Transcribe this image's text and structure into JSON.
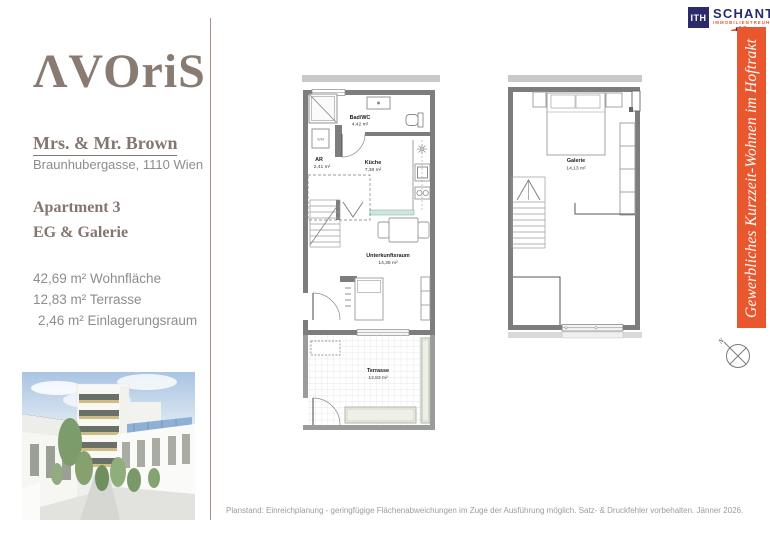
{
  "brand": {
    "logo_text": "ΛVOriS",
    "color": "#8a7b72"
  },
  "client": {
    "name": "Mrs. & Mr. Brown",
    "address": "Braunhubergasse, 1110 Wien"
  },
  "unit": {
    "title": "Apartment 3",
    "subtitle": "EG & Galerie"
  },
  "areas": {
    "line1": "42,69 m² Wohnfläche",
    "line2": "12,83 m² Terrasse",
    "line3": "2,46 m² Einlagerungsraum"
  },
  "plan_eg": {
    "rooms": {
      "bad": {
        "name": "Bad/WC",
        "area": "4,42 m²"
      },
      "ar": {
        "name": "AR",
        "area": "2,41 m²"
      },
      "wm_label": "WM",
      "kueche": {
        "name": "Küche",
        "area": "7,38 m²"
      },
      "unterkunftsraum": {
        "name": "Unterkunftsraum",
        "area": "14,35 m²"
      },
      "terrasse": {
        "name": "Terrasse",
        "area": "12,83 m²"
      }
    }
  },
  "plan_galerie": {
    "rooms": {
      "galerie": {
        "name": "Galerie",
        "area": "14,13 m²"
      }
    }
  },
  "broker": {
    "logo_square": "ITH",
    "name": "SCHANTL",
    "subtitle": "IMMOBILIENTREUHAND",
    "navy": "#2b2a6d",
    "orange": "#e8572e"
  },
  "banner": {
    "text": "Gewerbliches Kurzzeit-Wohnen im Hoftrakt",
    "background": "#e8572e"
  },
  "compass": {
    "north_label": "N"
  },
  "footer": {
    "disclaimer": "Planstand: Einreichplanung - geringfügige Flächenabweichungen im Zuge der Ausführung möglich. Satz- & Druckfehler vorbehalten. Jänner 2026."
  }
}
